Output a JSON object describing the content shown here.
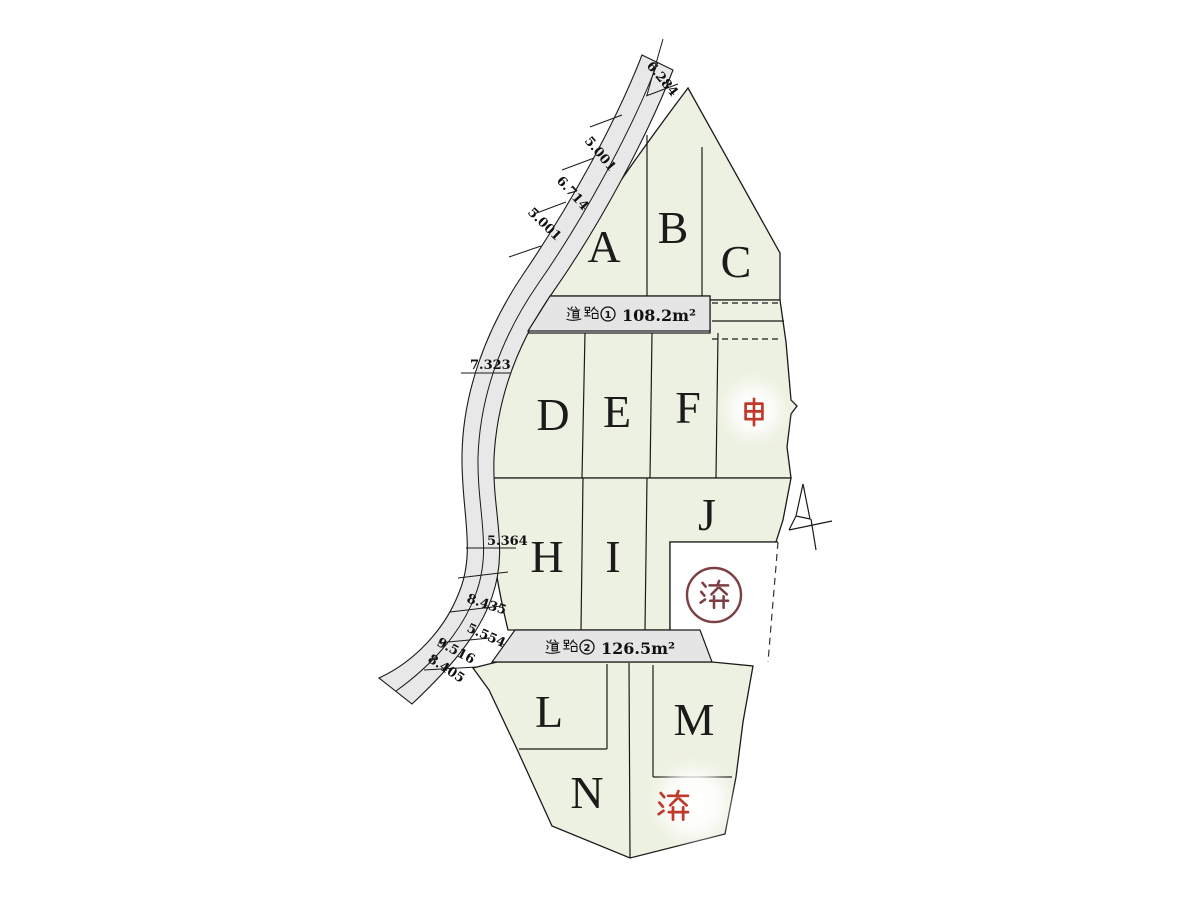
{
  "map": {
    "lot_labels": [
      "A",
      "B",
      "C",
      "D",
      "E",
      "F",
      "H",
      "I",
      "J",
      "L",
      "M",
      "N"
    ],
    "marks": {
      "pending_char": "申",
      "sold_char": "済",
      "pending_lots": 1,
      "sold_lots": 2
    },
    "roads": [
      {
        "label": "道路① 108.2㎡",
        "number": "1",
        "area_label": "108.2m²"
      },
      {
        "label": "道路② 126.5㎡",
        "number": "2",
        "area_label": "126.5m²"
      }
    ],
    "measurements": [
      "6.284",
      "5.001",
      "6.714",
      "5.001",
      "7.323",
      "5.364",
      "8.435",
      "5.554",
      "9.516",
      "8.405"
    ]
  },
  "colors": {
    "lot_fill": "#edf1e1",
    "road_fill": "#e8e8e8",
    "road_box_fill": "#e5e5e5",
    "line": "#1a1a1a",
    "pending_red": "#c03a2b",
    "sold_stamp_maroon": "#7d3f44"
  }
}
